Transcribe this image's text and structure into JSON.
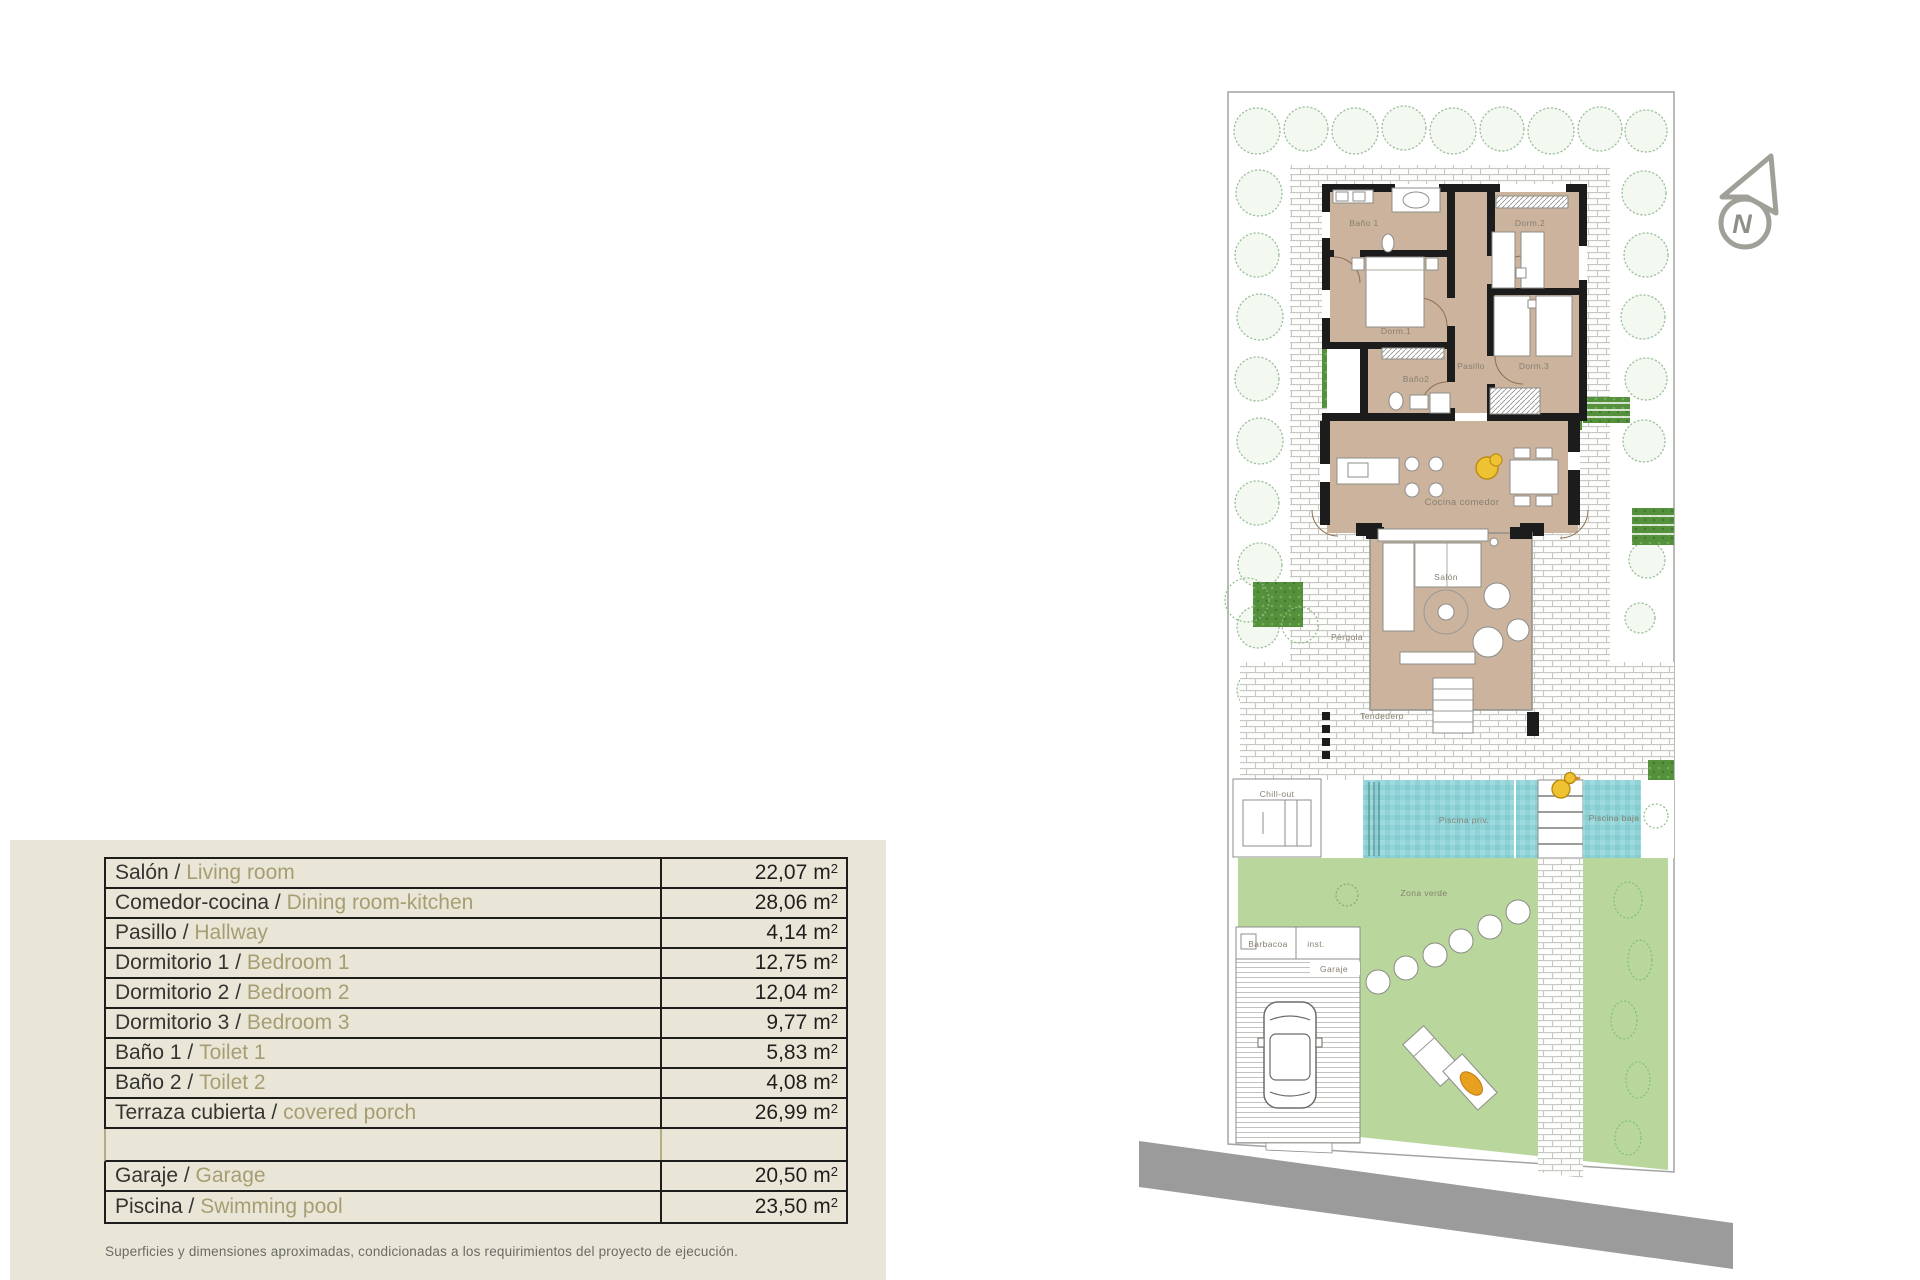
{
  "table": {
    "separator": " / ",
    "rows": [
      {
        "es": "Salón",
        "en": "Living room",
        "area": "22,07",
        "unit": "m",
        "sup": "2"
      },
      {
        "es": "Comedor-cocina",
        "en": "Dining room-kitchen",
        "area": "28,06",
        "unit": "m",
        "sup": "2"
      },
      {
        "es": "Pasillo",
        "en": "Hallway",
        "area": "4,14",
        "unit": "m",
        "sup": "2"
      },
      {
        "es": "Dormitorio 1",
        "en": "Bedroom 1",
        "area": "12,75",
        "unit": "m",
        "sup": "2"
      },
      {
        "es": "Dormitorio 2",
        "en": "Bedroom 2",
        "area": "12,04",
        "unit": "m",
        "sup": "2"
      },
      {
        "es": "Dormitorio 3",
        "en": "Bedroom 3",
        "area": "9,77",
        "unit": "m",
        "sup": "2"
      },
      {
        "es": "Baño 1",
        "en": "Toilet 1",
        "area": "5,83",
        "unit": "m",
        "sup": "2"
      },
      {
        "es": "Baño 2",
        "en": "Toilet 2",
        "area": "4,08",
        "unit": "m",
        "sup": "2"
      },
      {
        "es": "Terraza cubierta",
        "en": "covered porch",
        "area": "26,99",
        "unit": "m",
        "sup": "2"
      },
      {
        "es": "Garaje",
        "en": "Garage",
        "area": "20,50",
        "unit": "m",
        "sup": "2"
      },
      {
        "es": "Piscina",
        "en": "Swimming pool",
        "area": "23,50",
        "unit": "m",
        "sup": "2"
      }
    ],
    "footnote": "Superficies y dimensiones aproximadas, condicionadas a los requirimientos del proyecto de ejecución."
  },
  "plan": {
    "labels": {
      "bano1": "Baño 1",
      "dorm2": "Dorm.2",
      "dorm1": "Dorm.1",
      "bano2": "Baño2",
      "pasillo": "Pasillo",
      "dorm3": "Dorm.3",
      "cocina": "Cocina comedor",
      "salon": "Salón",
      "pergola": "Pérgola",
      "tendedero": "Tendedero",
      "chillout": "Chill-out",
      "piscina_priv": "Piscina priv.",
      "piscina_baja": "Piscina baja",
      "zona_verde": "Zona verde",
      "barbacoa": "Barbacoa",
      "inst": "inst.",
      "garaje": "Garaje"
    },
    "compass_letter": "N",
    "colors": {
      "panel": "#eae6d7",
      "floor_tan": "#cbb39e",
      "wall_black": "#1c1c1c",
      "pool_water": "#8fd3d7",
      "grass": "#b9d69c",
      "hedge_green": "#55913c",
      "road_gray": "#9b9b9b",
      "accent_yellow": "#eec233",
      "olive_text": "#a69d72"
    }
  }
}
